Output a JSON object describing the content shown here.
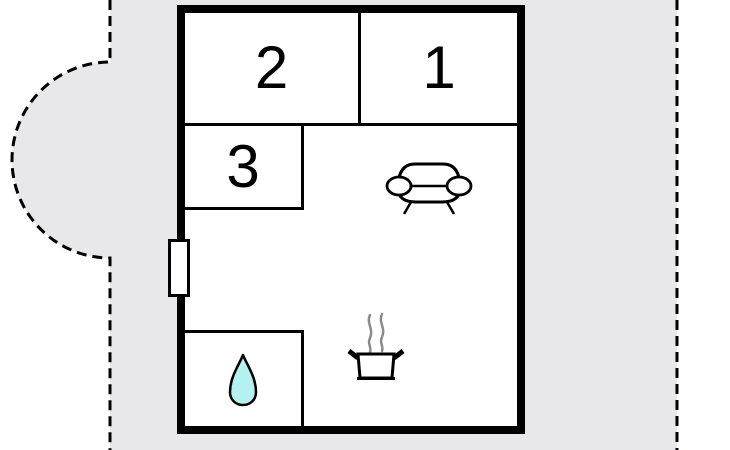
{
  "colors": {
    "canvas_bg": "#ffffff",
    "plot_area": "#e8e7ea",
    "wall": "#000000",
    "boundary_dash": "#000000",
    "water_drop": "#b6f1f1",
    "steam": "#8a8a8a",
    "icon_stroke": "#000000"
  },
  "floor_plan": {
    "rooms": [
      {
        "id": "room-1",
        "label": "1"
      },
      {
        "id": "room-2",
        "label": "2"
      },
      {
        "id": "room-3",
        "label": "3"
      }
    ],
    "icons": [
      {
        "name": "sofa-icon"
      },
      {
        "name": "stove-pot-icon"
      },
      {
        "name": "steam-icon"
      },
      {
        "name": "water-drop-icon"
      },
      {
        "name": "window-icon"
      },
      {
        "name": "property-boundary-dashed"
      }
    ]
  }
}
